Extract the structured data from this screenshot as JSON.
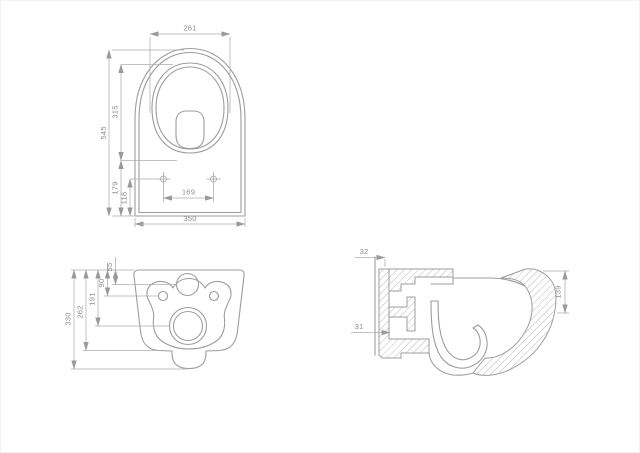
{
  "drawing": {
    "type": "technical-dimension-drawing",
    "subject": "wall-hung toilet, three orthographic views (plan, rear, sectional side)",
    "colors": {
      "background": "#ffffff",
      "line": "#9d9d9d",
      "dimension_line": "#adadad",
      "text": "#8d8d8d"
    },
    "dims": {
      "top_view": {
        "width_top": "261",
        "overall_depth": "545",
        "bowl_depth": "315",
        "rear_depth": "179",
        "holes_from_back": "116",
        "hole_spacing": "169",
        "width_bottom": "350"
      },
      "back_view": {
        "overall_height": "330",
        "body_height": "262",
        "drain_center": "191",
        "hole_line": "90",
        "inlet_center": "55"
      },
      "side_view": {
        "wall_offset": "32",
        "flange_thickness": "31",
        "front_height": "139"
      }
    }
  }
}
